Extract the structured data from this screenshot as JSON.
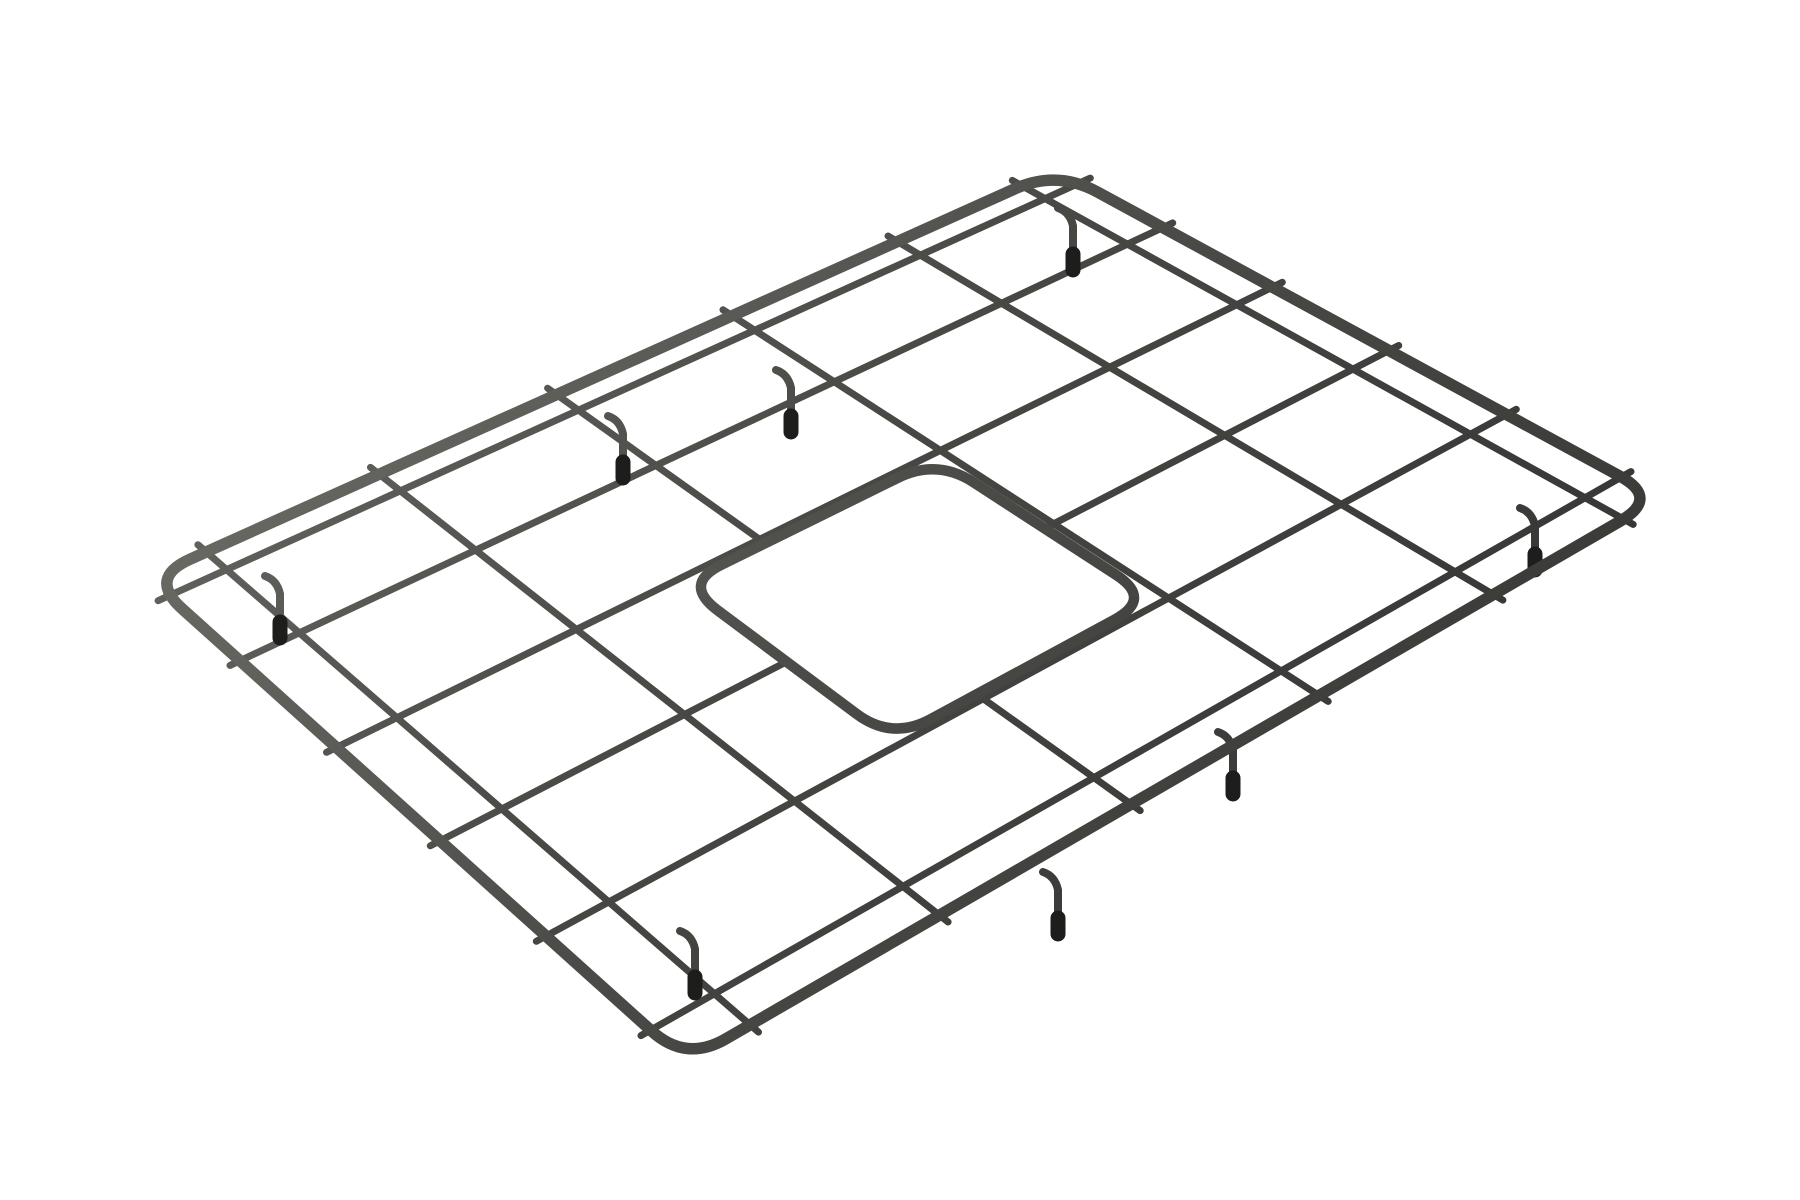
{
  "page": {
    "background_color": "#ffffff"
  },
  "product_photo": {
    "alt": "Matte dark gunmetal wire sink bottom grid with rounded corners, a rounded-square center drain opening, and black rubber feet, photographed in perspective on a white background",
    "object_type": "sink-bottom-grid",
    "finish": "matte gunmetal gray",
    "background": "white seamless",
    "wires_per_direction": 6,
    "feet_count": 8,
    "colors": {
      "wire_highlight": "#6b6b66",
      "wire_mid": "#474744",
      "wire_dark": "#313130",
      "frame_highlight": "#73736d",
      "frame_mid": "#4a4a47",
      "frame_dark": "#343432",
      "rubber_cap": "#1d1d1c",
      "background": "#ffffff"
    },
    "geometry": {
      "frame": {
        "corner_top": [
          1057,
          170
        ],
        "corner_right": [
          1660,
          498
        ],
        "corner_bottom": [
          686,
          1062
        ],
        "corner_left": [
          148,
          578
        ],
        "corner_cut": 46,
        "stroke_width": 11.5
      },
      "mesh": {
        "stroke_width": 7,
        "overhang": 11,
        "s_positions": [
          0.045,
          0.2,
          0.395,
          0.59,
          0.775,
          0.945
        ],
        "t_positions": [
          0.045,
          0.2,
          0.395,
          0.59,
          0.775,
          0.945
        ],
        "interrupted_s": [
          0.59
        ],
        "interrupted_t": [
          0.59
        ]
      },
      "cutout_ring": {
        "s0": 0.405,
        "s1": 0.765,
        "t0": 0.405,
        "t1": 0.675,
        "corner_cut": 44,
        "stroke_width": 10.5,
        "stub_overhang": 9
      },
      "feet": {
        "wire_stroke": 8,
        "cap_stroke": 15,
        "cap_length": 16,
        "positions": [
          [
            1073,
            262
          ],
          [
            791,
            424
          ],
          [
            623,
            470
          ],
          [
            280,
            630
          ],
          [
            695,
            985
          ],
          [
            1058,
            926
          ],
          [
            1233,
            786
          ],
          [
            1535,
            562
          ]
        ]
      }
    }
  }
}
